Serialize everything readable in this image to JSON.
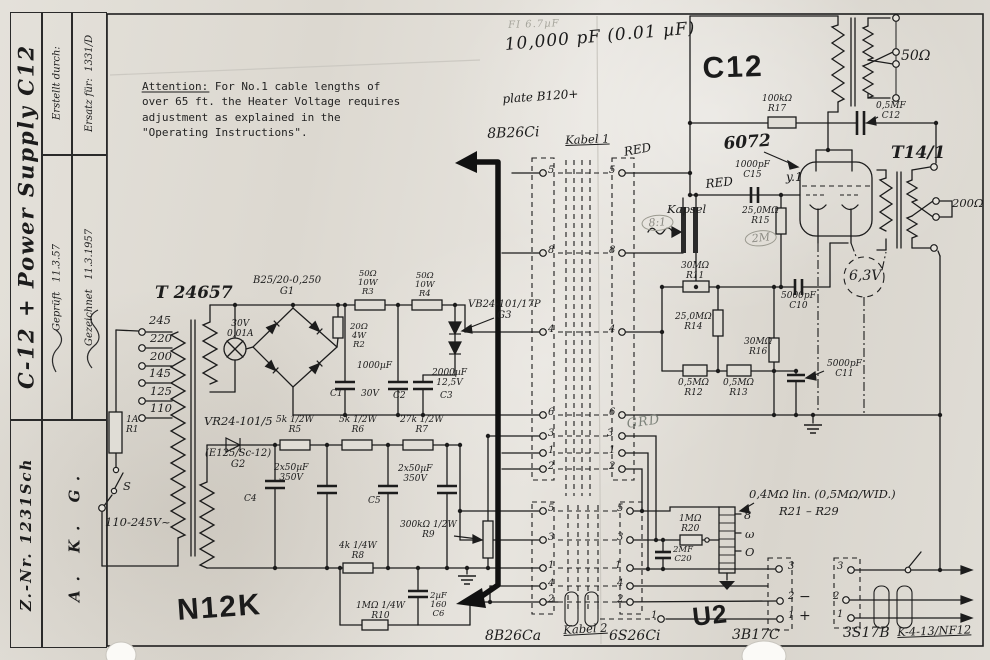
{
  "title_block": {
    "title": "C-12 + Power Supply C12",
    "number": "Z.-Nr. 1231Sch",
    "company": "A. K. G.",
    "ersatz": "Ersatz für:  1331/D",
    "erstellt": "Erstellt durch:",
    "gezeichnet": "Gezeichnet   11.3.1957",
    "geprueft": "Geprüft   11.3.57"
  },
  "colors": {
    "paper": "#dedad3",
    "ink": "#1c1c1c",
    "pencil": "#8d8c85"
  },
  "labels": [
    {
      "n": "note-attention",
      "t": "Attention: For No.1 cable lengths of\nover 65 ft. the Heater Voltage requires\nadjustment as explained in the\n\"Operating Instructions\".",
      "x": 142,
      "y": 79,
      "c": "typed",
      "w": 320
    },
    {
      "n": "pencil-fi",
      "t": "FI 6.7µF",
      "x": 508,
      "y": 20,
      "c": "pencil2",
      "r": -2
    },
    {
      "n": "ink-cap-value",
      "t": "10,000 pF  (0.01 µF)",
      "x": 504,
      "y": 36,
      "c": "ink-big",
      "r": -5
    },
    {
      "n": "ink-plate-voltage",
      "t": "plate B120+",
      "x": 502,
      "y": 93,
      "c": "ink",
      "r": -4
    },
    {
      "n": "stamp-c12",
      "t": "C12",
      "x": 702,
      "y": 52,
      "c": "stamp-lg",
      "r": -2
    },
    {
      "n": "lbl-8b26ci",
      "t": "8B26Ci",
      "x": 487,
      "y": 127,
      "c": "hand-md",
      "r": -2
    },
    {
      "n": "lbl-kabel1",
      "t": "Kabel 1",
      "x": 565,
      "y": 134,
      "c": "hand underl",
      "r": -2
    },
    {
      "n": "lbl-red-cable",
      "t": "RED",
      "x": 623,
      "y": 146,
      "c": "ink",
      "r": -10
    },
    {
      "n": "lbl-r17",
      "t": "100kΩ\nR17",
      "x": 762,
      "y": 94,
      "c": "hand2"
    },
    {
      "n": "lbl-c12-cap",
      "t": "0,5MF\nC12",
      "x": 876,
      "y": 101,
      "c": "hand2"
    },
    {
      "n": "lbl-6072",
      "t": "6072",
      "x": 723,
      "y": 135,
      "c": "hand-lg",
      "r": -4
    },
    {
      "n": "lbl-c15",
      "t": "1000pF\nC15",
      "x": 735,
      "y": 160,
      "c": "hand2"
    },
    {
      "n": "lbl-red-grid",
      "t": "RED",
      "x": 705,
      "y": 178,
      "c": "ink",
      "r": -6
    },
    {
      "n": "lbl-tube-v1",
      "t": "y.1",
      "x": 786,
      "y": 171,
      "c": "ink"
    },
    {
      "n": "lbl-kapsel",
      "t": "Kapsel",
      "x": 667,
      "y": 203,
      "c": "hand"
    },
    {
      "n": "pencil-8-1",
      "t": "8:1",
      "x": 641,
      "y": 216,
      "c": "pencil oval",
      "r": -4
    },
    {
      "n": "lbl-r15",
      "t": "25,0MΩ\nR15",
      "x": 742,
      "y": 206,
      "c": "hand2"
    },
    {
      "n": "pencil-2m",
      "t": "2M",
      "x": 744,
      "y": 232,
      "c": "pencil oval",
      "r": -6
    },
    {
      "n": "lbl-r11",
      "t": "30MΩ\nR11",
      "x": 681,
      "y": 261,
      "c": "hand2"
    },
    {
      "n": "lbl-r14",
      "t": "25,0MΩ\nR14",
      "x": 675,
      "y": 312,
      "c": "hand2"
    },
    {
      "n": "lbl-r16",
      "t": "30MΩ\nR16",
      "x": 744,
      "y": 337,
      "c": "hand2"
    },
    {
      "n": "lbl-r12",
      "t": "0,5MΩ\nR12",
      "x": 678,
      "y": 378,
      "c": "hand2"
    },
    {
      "n": "lbl-r13",
      "t": "0,5MΩ\nR13",
      "x": 723,
      "y": 378,
      "c": "hand2"
    },
    {
      "n": "lbl-c10",
      "t": "5000pF\nC10",
      "x": 781,
      "y": 291,
      "c": "hand2"
    },
    {
      "n": "lbl-c11",
      "t": "5000pF\nC11",
      "x": 827,
      "y": 359,
      "c": "hand2"
    },
    {
      "n": "lbl-6-3v",
      "t": "6,3V",
      "x": 849,
      "y": 269,
      "c": "hand-md"
    },
    {
      "n": "lbl-t14-1",
      "t": "T14/1",
      "x": 891,
      "y": 144,
      "c": "hand-lg"
    },
    {
      "n": "lbl-200ohm",
      "t": "200Ω",
      "x": 952,
      "y": 197,
      "c": "hand"
    },
    {
      "n": "lbl-50ohm",
      "t": "50Ω",
      "x": 901,
      "y": 49,
      "c": "hand-md"
    },
    {
      "n": "lbl-t24657",
      "t": "T 24657",
      "x": 155,
      "y": 284,
      "c": "hand-lg"
    },
    {
      "n": "lbl-g1",
      "t": "B25/20-0,250\nG1",
      "x": 253,
      "y": 275,
      "c": "hand2b"
    },
    {
      "n": "lbl-lamp",
      "t": "30V\n0,01A",
      "x": 227,
      "y": 319,
      "c": "hand2"
    },
    {
      "n": "lbl-tap-245",
      "t": "245",
      "x": 149,
      "y": 314,
      "c": "hand"
    },
    {
      "n": "lbl-tap-220",
      "t": "220",
      "x": 150,
      "y": 332,
      "c": "hand"
    },
    {
      "n": "lbl-tap-200",
      "t": "200",
      "x": 150,
      "y": 350,
      "c": "hand"
    },
    {
      "n": "lbl-tap-145",
      "t": "145",
      "x": 149,
      "y": 367,
      "c": "hand"
    },
    {
      "n": "lbl-tap-125",
      "t": "125",
      "x": 150,
      "y": 385,
      "c": "hand"
    },
    {
      "n": "lbl-tap-110",
      "t": "110",
      "x": 150,
      "y": 402,
      "c": "hand"
    },
    {
      "n": "lbl-r1",
      "t": "1A\nR1",
      "x": 126,
      "y": 415,
      "c": "hand2"
    },
    {
      "n": "lbl-switch-s",
      "t": "S",
      "x": 123,
      "y": 480,
      "c": "hand"
    },
    {
      "n": "lbl-mains",
      "t": "110-245V~",
      "x": 105,
      "y": 516,
      "c": "hand"
    },
    {
      "n": "lbl-r3",
      "t": "50Ω\n10W\nR3",
      "x": 358,
      "y": 270,
      "c": "hand3"
    },
    {
      "n": "lbl-r4",
      "t": "50Ω\n10W\nR4",
      "x": 415,
      "y": 272,
      "c": "hand3"
    },
    {
      "n": "lbl-r2",
      "t": "20Ω\n4W\nR2",
      "x": 350,
      "y": 323,
      "c": "hand3"
    },
    {
      "n": "lbl-g3",
      "t": "VB24-101/17P\nG3",
      "x": 468,
      "y": 299,
      "c": "hand2b"
    },
    {
      "n": "lbl-c1-val",
      "t": "1000µF",
      "x": 357,
      "y": 361,
      "c": "hand2"
    },
    {
      "n": "lbl-c1",
      "t": "C1",
      "x": 330,
      "y": 389,
      "c": "hand2"
    },
    {
      "n": "lbl-c1-30v",
      "t": "30V",
      "x": 361,
      "y": 389,
      "c": "hand2"
    },
    {
      "n": "lbl-c2",
      "t": "C2",
      "x": 393,
      "y": 391,
      "c": "hand2"
    },
    {
      "n": "lbl-c3-val",
      "t": "2000µF\n12,5V",
      "x": 432,
      "y": 368,
      "c": "hand2"
    },
    {
      "n": "lbl-c3",
      "t": "C3",
      "x": 440,
      "y": 391,
      "c": "hand2"
    },
    {
      "n": "lbl-vr24",
      "t": "VR24-101/5",
      "x": 204,
      "y": 415,
      "c": "hand"
    },
    {
      "n": "lbl-g2",
      "t": "(E125/Sc-12)\nG2",
      "x": 205,
      "y": 448,
      "c": "hand2b"
    },
    {
      "n": "lbl-r5",
      "t": "5k 1/2W\nR5",
      "x": 276,
      "y": 415,
      "c": "hand2"
    },
    {
      "n": "lbl-r6",
      "t": "5k 1/2W\nR6",
      "x": 339,
      "y": 415,
      "c": "hand2"
    },
    {
      "n": "lbl-r7",
      "t": "27k 1/2W\nR7",
      "x": 400,
      "y": 415,
      "c": "hand2"
    },
    {
      "n": "lbl-c4-val",
      "t": "2x50µF\n350V",
      "x": 274,
      "y": 463,
      "c": "hand2"
    },
    {
      "n": "lbl-c4",
      "t": "C4",
      "x": 244,
      "y": 494,
      "c": "hand2"
    },
    {
      "n": "lbl-c5-val",
      "t": "2x50µF\n350V",
      "x": 398,
      "y": 464,
      "c": "hand2"
    },
    {
      "n": "lbl-c5",
      "t": "C5",
      "x": 368,
      "y": 496,
      "c": "hand2"
    },
    {
      "n": "lbl-r9",
      "t": "300kΩ 1/2W\nR9",
      "x": 400,
      "y": 520,
      "c": "hand2"
    },
    {
      "n": "lbl-r8",
      "t": "4k 1/4W\nR8",
      "x": 339,
      "y": 541,
      "c": "hand2"
    },
    {
      "n": "lbl-r10",
      "t": "1MΩ 1/4W\nR10",
      "x": 356,
      "y": 601,
      "c": "hand2"
    },
    {
      "n": "lbl-c6",
      "t": "2µF\n160\nC6",
      "x": 430,
      "y": 592,
      "c": "hand3"
    },
    {
      "n": "stamp-n12k",
      "t": "N12K",
      "x": 176,
      "y": 594,
      "c": "stamp-lg",
      "r": -4
    },
    {
      "n": "pencil-grd",
      "t": "GRD",
      "x": 626,
      "y": 418,
      "c": "pencil-grn",
      "r": -8
    },
    {
      "n": "lbl-kabel2",
      "t": "Kabel 2",
      "x": 563,
      "y": 624,
      "c": "hand underl",
      "r": -3
    },
    {
      "n": "lbl-8b26ca",
      "t": "8B26Ca",
      "x": 485,
      "y": 629,
      "c": "hand-md"
    },
    {
      "n": "lbl-6s26ci",
      "t": "6S26Ci",
      "x": 609,
      "y": 629,
      "c": "hand-md"
    },
    {
      "n": "stamp-u2",
      "t": "U2",
      "x": 691,
      "y": 603,
      "c": "stamp-md",
      "r": -6
    },
    {
      "n": "lbl-3b17c",
      "t": "3B17C",
      "x": 732,
      "y": 628,
      "c": "hand-md"
    },
    {
      "n": "lbl-3s17b",
      "t": "3S17B",
      "x": 843,
      "y": 626,
      "c": "hand-md"
    },
    {
      "n": "lbl-nf12",
      "t": "K-4-13/NF12",
      "x": 897,
      "y": 626,
      "c": "hand underl",
      "r": -2
    },
    {
      "n": "lbl-r20",
      "t": "1MΩ\nR20",
      "x": 679,
      "y": 514,
      "c": "hand2"
    },
    {
      "n": "lbl-c20",
      "t": "2MF\nC20",
      "x": 673,
      "y": 546,
      "c": "hand3"
    },
    {
      "n": "lbl-r21-29-val",
      "t": "0,4MΩ lin. (0,5MΩ/WID.)",
      "x": 749,
      "y": 488,
      "c": "hand"
    },
    {
      "n": "lbl-r21-29",
      "t": "R21 – R29",
      "x": 779,
      "y": 505,
      "c": "hand"
    },
    {
      "n": "lbl-ladder-8",
      "t": "8",
      "x": 744,
      "y": 509,
      "c": "hand"
    },
    {
      "n": "lbl-ladder-omni",
      "t": "ω",
      "x": 745,
      "y": 528,
      "c": "hand"
    },
    {
      "n": "lbl-ladder-o",
      "t": "O",
      "x": 745,
      "y": 546,
      "c": "hand"
    },
    {
      "n": "lbl-minus",
      "t": "−",
      "x": 799,
      "y": 590,
      "c": "hand-md"
    },
    {
      "n": "lbl-plus",
      "t": "+",
      "x": 799,
      "y": 609,
      "c": "hand-md"
    },
    {
      "n": "pin-k1l-5",
      "t": "5",
      "x": 548,
      "y": 165,
      "c": "pnum"
    },
    {
      "n": "pin-k1l-8",
      "t": "8",
      "x": 548,
      "y": 245,
      "c": "pnum"
    },
    {
      "n": "pin-k1l-4",
      "t": "4",
      "x": 548,
      "y": 324,
      "c": "pnum"
    },
    {
      "n": "pin-k1l-6",
      "t": "6",
      "x": 548,
      "y": 407,
      "c": "pnum"
    },
    {
      "n": "pin-k1l-3",
      "t": "3",
      "x": 548,
      "y": 428,
      "c": "pnum"
    },
    {
      "n": "pin-k1l-1",
      "t": "1",
      "x": 548,
      "y": 445,
      "c": "pnum"
    },
    {
      "n": "pin-k1l-2",
      "t": "2",
      "x": 548,
      "y": 461,
      "c": "pnum"
    },
    {
      "n": "pin-k1r-5",
      "t": "5",
      "x": 609,
      "y": 165,
      "c": "pnum"
    },
    {
      "n": "pin-k1r-8",
      "t": "8",
      "x": 609,
      "y": 245,
      "c": "pnum"
    },
    {
      "n": "pin-k1r-4",
      "t": "4",
      "x": 609,
      "y": 324,
      "c": "pnum"
    },
    {
      "n": "pin-k1r-6",
      "t": "6",
      "x": 609,
      "y": 407,
      "c": "pnum"
    },
    {
      "n": "pin-k1r-3",
      "t": "3",
      "x": 607,
      "y": 428,
      "c": "pnum"
    },
    {
      "n": "pin-k1r-1",
      "t": "1",
      "x": 609,
      "y": 445,
      "c": "pnum"
    },
    {
      "n": "pin-k1r-2",
      "t": "2",
      "x": 609,
      "y": 461,
      "c": "pnum"
    },
    {
      "n": "pin-k2l-5",
      "t": "5",
      "x": 548,
      "y": 503,
      "c": "pnum"
    },
    {
      "n": "pin-k2l-3",
      "t": "3",
      "x": 548,
      "y": 532,
      "c": "pnum"
    },
    {
      "n": "pin-k2l-1",
      "t": "1",
      "x": 548,
      "y": 560,
      "c": "pnum"
    },
    {
      "n": "pin-k2l-4",
      "t": "4",
      "x": 548,
      "y": 578,
      "c": "pnum"
    },
    {
      "n": "pin-k2l-2",
      "t": "2",
      "x": 548,
      "y": 594,
      "c": "pnum"
    },
    {
      "n": "pin-k2r-5",
      "t": "5",
      "x": 617,
      "y": 503,
      "c": "pnum"
    },
    {
      "n": "pin-k2r-3",
      "t": "3",
      "x": 617,
      "y": 532,
      "c": "pnum"
    },
    {
      "n": "pin-k2r-1",
      "t": "1",
      "x": 615,
      "y": 560,
      "c": "pnum"
    },
    {
      "n": "pin-k2r-4",
      "t": "4",
      "x": 617,
      "y": 578,
      "c": "pnum"
    },
    {
      "n": "pin-k2r-2",
      "t": "2",
      "x": 617,
      "y": 594,
      "c": "pnum"
    },
    {
      "n": "pin-u2-3",
      "t": "3",
      "x": 788,
      "y": 561,
      "c": "pnum"
    },
    {
      "n": "pin-u2-2",
      "t": "2",
      "x": 788,
      "y": 591,
      "c": "pnum"
    },
    {
      "n": "pin-u2-1",
      "t": "1",
      "x": 788,
      "y": 610,
      "c": "pnum"
    },
    {
      "n": "pin-mid-1",
      "t": "1",
      "x": 651,
      "y": 610,
      "c": "pnum"
    },
    {
      "n": "pin-3s17b-3",
      "t": "3",
      "x": 837,
      "y": 561,
      "c": "pnum"
    },
    {
      "n": "pin-3s17b-2",
      "t": "2",
      "x": 833,
      "y": 591,
      "c": "pnum"
    },
    {
      "n": "pin-3s17b-1",
      "t": "1",
      "x": 837,
      "y": 609,
      "c": "pnum"
    }
  ]
}
